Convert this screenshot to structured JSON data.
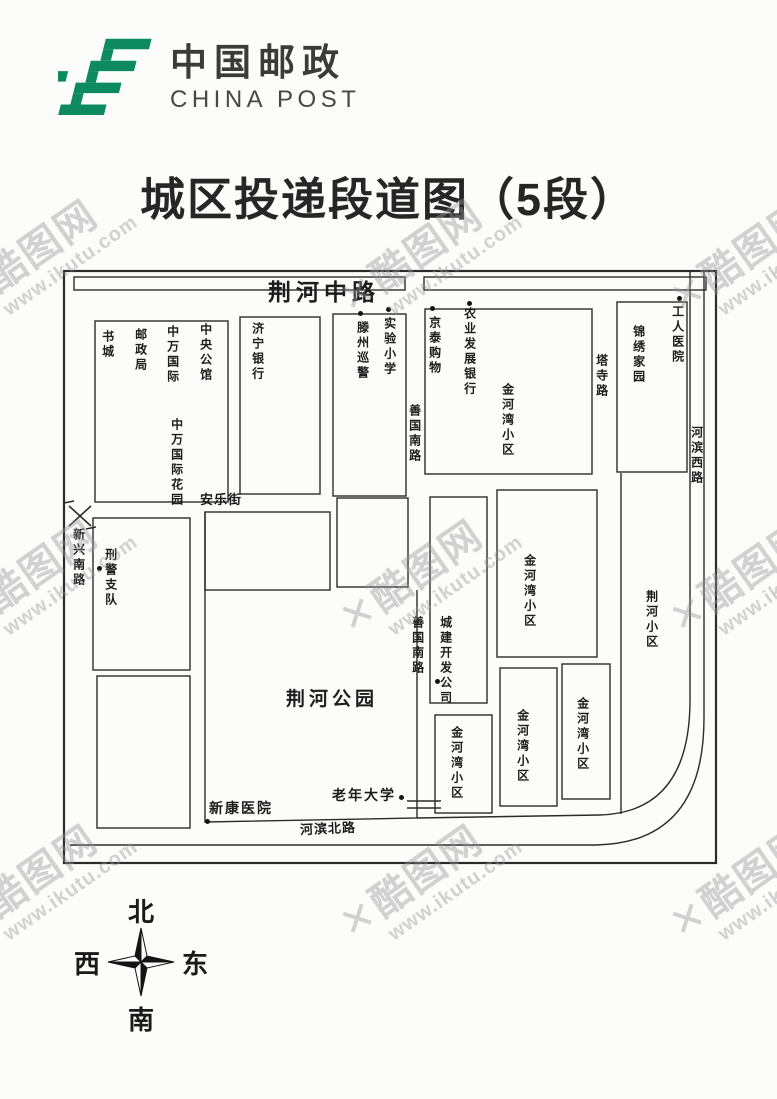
{
  "logo": {
    "cn": "中国邮政",
    "en": "CHINA POST",
    "green": "#0d8a5f"
  },
  "title": "城区投递段道图（5段）",
  "watermark": {
    "k": "✕",
    "brand": "酷图网",
    "url": "www.ikutu.com"
  },
  "compass": {
    "north": "北",
    "south": "南",
    "east": "东",
    "west": "西"
  },
  "map": {
    "roads": {
      "jinghe_middle": "荆河中路",
      "anle_street": "安乐街",
      "xinxing_south": "新兴南路",
      "shanguo_south_upper": "善国南路",
      "shanguo_south_lower": "善国南路",
      "tasi": "塔寺路",
      "hebin_west": "河滨西路",
      "hebin_north": "河滨北路"
    },
    "places": {
      "book_city": "书城",
      "post_office": "邮政局",
      "zhongwan_intl": "中万国际",
      "central_mansion": "中央公馆",
      "zhongwan_garden": "中万国际花园",
      "jining_bank": "济宁银行",
      "tengzhou_patrol": "滕州巡警",
      "experimental_school": "实验小学",
      "jingtai_shopping": "京泰购物",
      "agri_dev_bank": "农业发展银行",
      "jinhewan_big": "金河湾小区",
      "jinxiu_home": "锦绣家园",
      "workers_hospital": "工人医院",
      "police_detachment": "刑警支队",
      "jinghe_park": "荆河公园",
      "chengjian_dev": "城建开发公司",
      "jinhewan_mid": "金河湾小区",
      "jinghe_xiaoqu": "荆河小区",
      "jinhewan_s1": "金河湾小区",
      "jinhewan_s2": "金河湾小区",
      "jinhewan_s3": "金河湾小区",
      "senior_university": "老年大学",
      "xinkang_hospital": "新康医院"
    }
  }
}
